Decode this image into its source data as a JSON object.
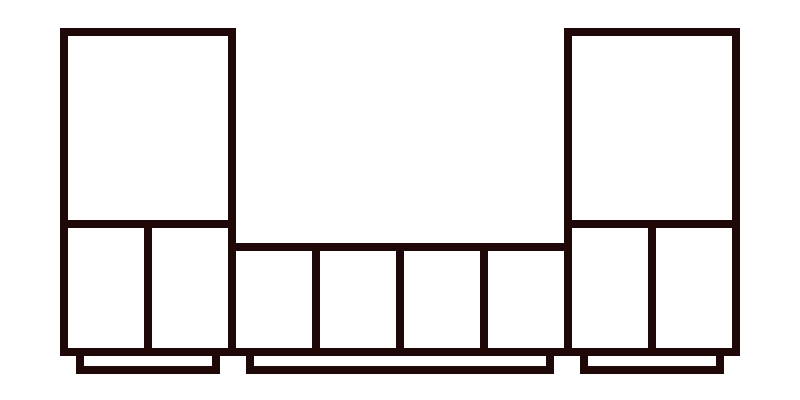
{
  "canvas": {
    "width": 800,
    "height": 400,
    "background_color": "#ffffff"
  },
  "diagram": {
    "description": "furniture-wall-unit-elevation",
    "stroke_color": "#1f0908",
    "stroke_width": 8,
    "components": [
      "left-tall-cabinet",
      "center-low-cabinet-run",
      "right-tall-cabinet",
      "left-plinth",
      "center-plinth",
      "right-plinth"
    ],
    "shapes": [
      {
        "name": "left-tall-cabinet-frame",
        "x": 60,
        "y": 28,
        "w": 176,
        "h": 328,
        "kind": "frame",
        "borders": "all"
      },
      {
        "name": "left-cabinet-shelf-divider",
        "x": 60,
        "y": 220,
        "w": 176,
        "h": 8,
        "kind": "bar"
      },
      {
        "name": "left-cabinet-door-divider",
        "x": 144,
        "y": 228,
        "w": 8,
        "h": 120,
        "kind": "bar"
      },
      {
        "name": "right-tall-cabinet-frame",
        "x": 564,
        "y": 28,
        "w": 176,
        "h": 328,
        "kind": "frame",
        "borders": "all"
      },
      {
        "name": "right-cabinet-shelf-divider",
        "x": 564,
        "y": 220,
        "w": 176,
        "h": 8,
        "kind": "bar"
      },
      {
        "name": "right-cabinet-door-divider",
        "x": 648,
        "y": 228,
        "w": 8,
        "h": 120,
        "kind": "bar"
      },
      {
        "name": "center-low-cabinet-frame",
        "x": 236,
        "y": 243,
        "w": 328,
        "h": 113,
        "kind": "frame",
        "borders": "tb"
      },
      {
        "name": "center-door-divider-1",
        "x": 312,
        "y": 251,
        "w": 8,
        "h": 97,
        "kind": "bar"
      },
      {
        "name": "center-door-divider-2",
        "x": 396,
        "y": 251,
        "w": 8,
        "h": 97,
        "kind": "bar"
      },
      {
        "name": "center-door-divider-3",
        "x": 480,
        "y": 251,
        "w": 8,
        "h": 97,
        "kind": "bar"
      },
      {
        "name": "left-plinth",
        "x": 76,
        "y": 348,
        "w": 144,
        "h": 26,
        "kind": "frame",
        "borders": "all"
      },
      {
        "name": "center-plinth",
        "x": 246,
        "y": 348,
        "w": 308,
        "h": 26,
        "kind": "frame",
        "borders": "all"
      },
      {
        "name": "right-plinth",
        "x": 580,
        "y": 348,
        "w": 144,
        "h": 26,
        "kind": "frame",
        "borders": "all"
      }
    ]
  }
}
